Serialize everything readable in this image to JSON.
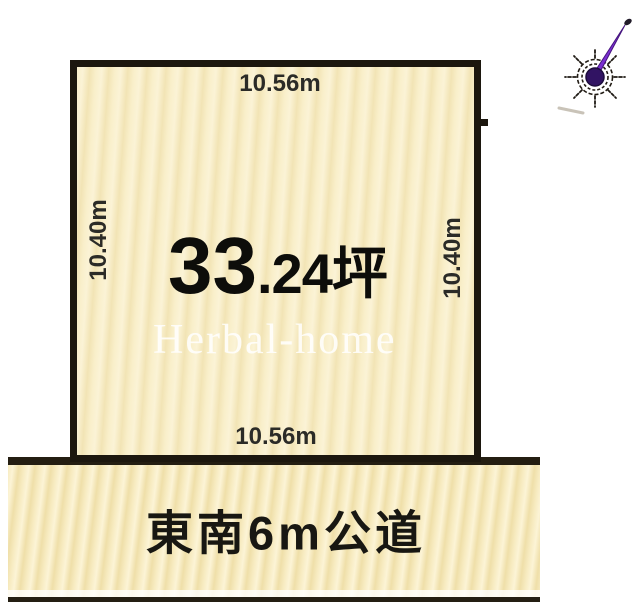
{
  "diagram": {
    "plot": {
      "top_length": "10.56m",
      "bottom_length": "10.56m",
      "left_length": "10.40m",
      "right_length": "10.40m",
      "area_big": "33",
      "area_small": ".24坪",
      "fill_color": "#f8eec8",
      "border_color": "#1c170e"
    },
    "road": {
      "label": "東南6m公道",
      "fill_color": "#f6e9bb",
      "border_color": "#241e12"
    },
    "watermark": {
      "text": "Herbal-home",
      "color": "#ffffff"
    },
    "compass": {
      "icon": "north-arrow-compass",
      "needle_color": "#7a2fd0"
    }
  }
}
